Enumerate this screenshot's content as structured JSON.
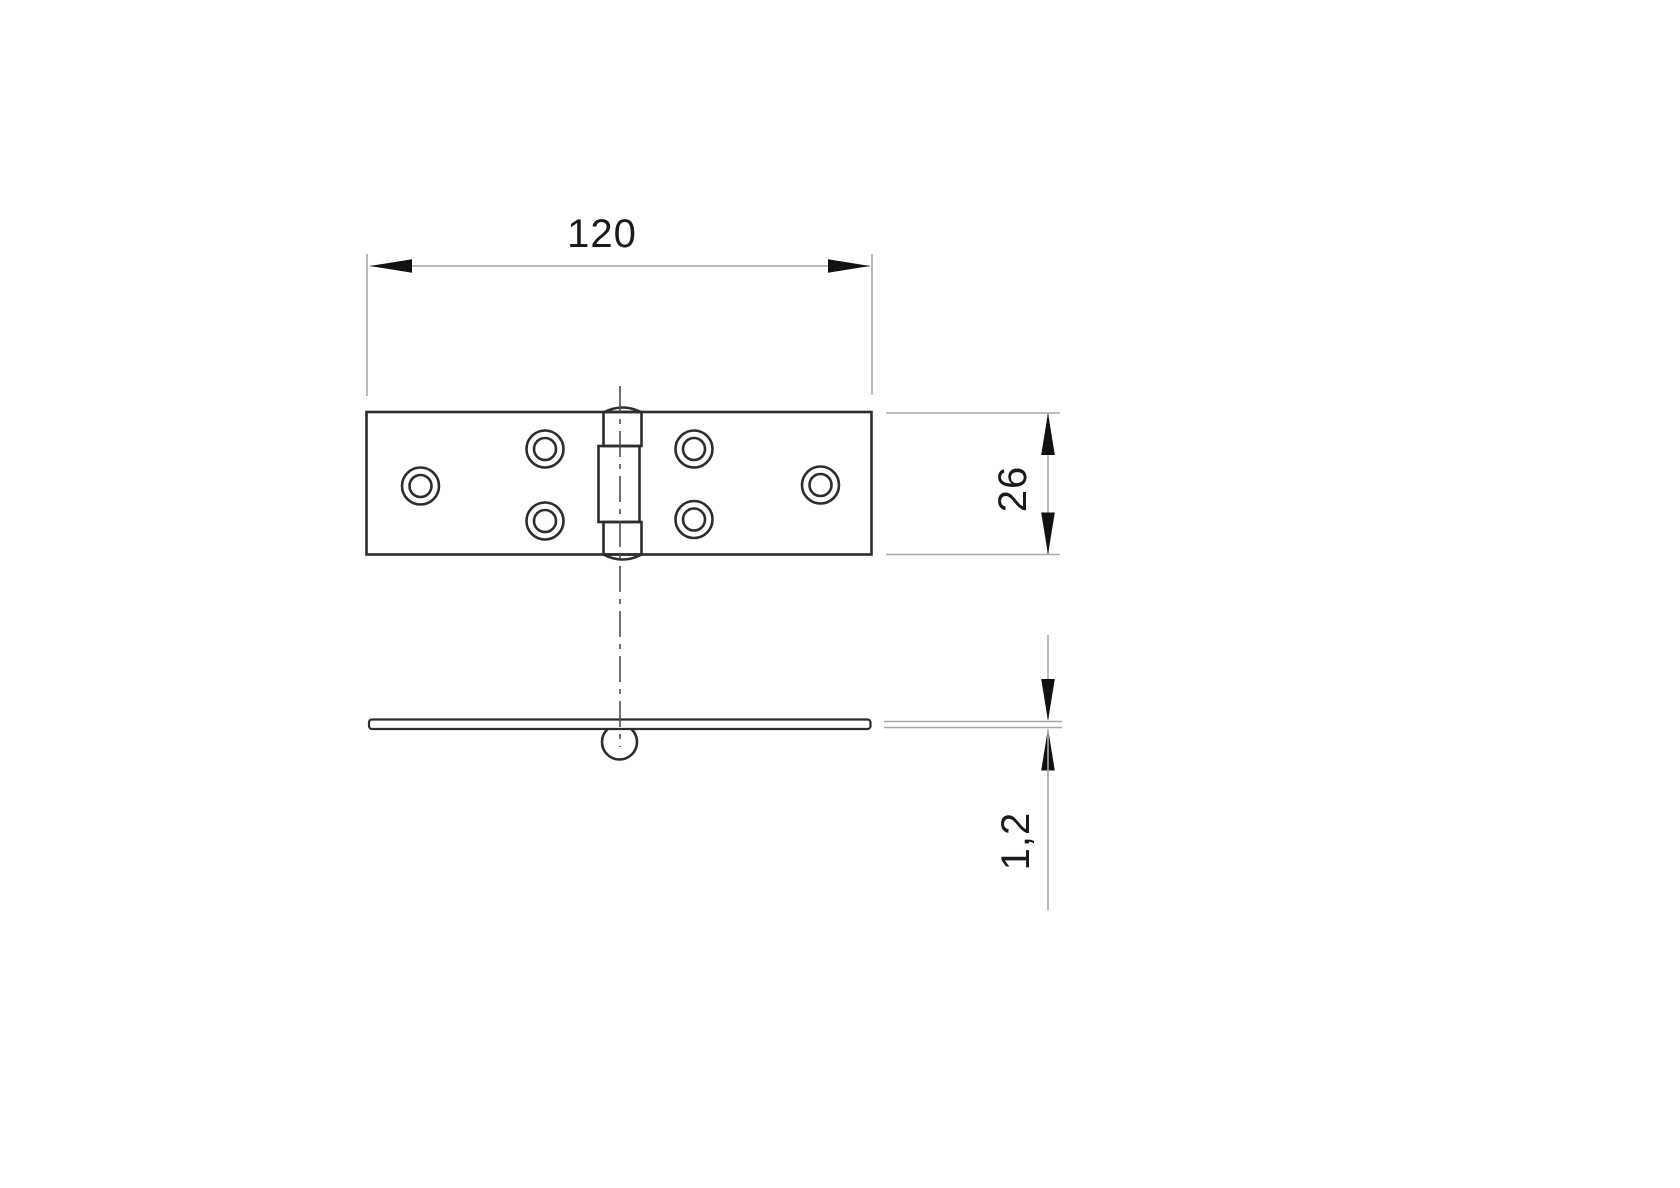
{
  "drawing": {
    "type": "technical-drawing",
    "subject": "flat hinge, top view and side profile view",
    "dimensions": {
      "length": "120",
      "width": "26",
      "thickness": "1,2"
    },
    "top_view": {
      "screw_holes": 6,
      "knuckle_segments": 3
    },
    "side_view": {
      "parts": [
        "leaf-profile",
        "pin-barrel-circle"
      ]
    },
    "colors": {
      "background": "#ffffff",
      "outline": "#2d2d2d",
      "dimension_line": "#a8a8a8",
      "arrow": "#111111",
      "centerline": "#4d4d4d",
      "text": "#191922"
    }
  }
}
